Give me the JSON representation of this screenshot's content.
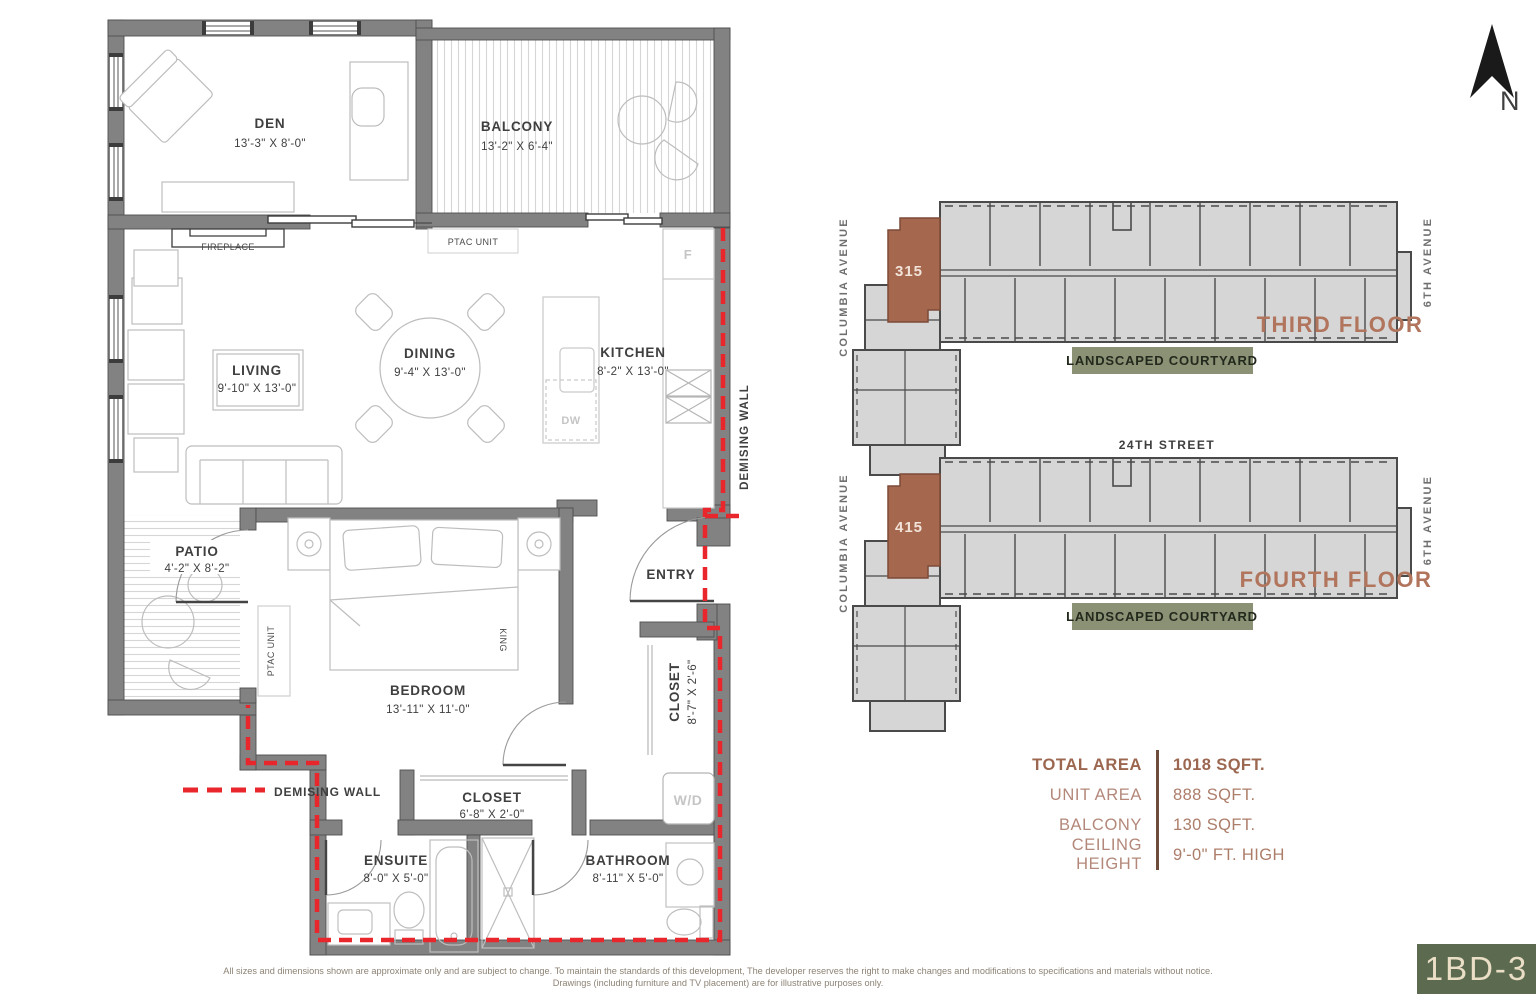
{
  "floorplan": {
    "rooms": {
      "den": {
        "name": "DEN",
        "dims": "13'-3\" X 8'-0\""
      },
      "balcony": {
        "name": "BALCONY",
        "dims": "13'-2\" X 6'-4\""
      },
      "living": {
        "name": "LIVING",
        "dims": "9'-10\" X 13'-0\""
      },
      "dining": {
        "name": "DINING",
        "dims": "9'-4\" X 13'-0\""
      },
      "kitchen": {
        "name": "KITCHEN",
        "dims": "8'-2\" X 13'-0\""
      },
      "patio": {
        "name": "PATIO",
        "dims": "4'-2\" X 8'-2\""
      },
      "bedroom": {
        "name": "BEDROOM",
        "dims": "13'-11\" X 11'-0\""
      },
      "entry": {
        "name": "ENTRY"
      },
      "entry_closet": {
        "name": "CLOSET",
        "dims": "8'-7\" X 2'-6\""
      },
      "bedroom_closet": {
        "name": "CLOSET",
        "dims": "6'-8\" X 2'-0\""
      },
      "ensuite": {
        "name": "ENSUITE",
        "dims": "8'-0\" X 5'-0\""
      },
      "bathroom": {
        "name": "BATHROOM",
        "dims": "8'-11\" X 5'-0\""
      }
    },
    "labels": {
      "fireplace": "FIREPLACE",
      "ptac_balcony": "PTAC UNIT",
      "ptac_patio": "PTAC UNIT",
      "fridge": "F",
      "dishwasher": "DW",
      "washer_dryer": "W/D",
      "king": "KING",
      "demising_vertical": "DEMISING WALL",
      "demising_legend": "DEMISING WALL"
    }
  },
  "keyplans": {
    "third": {
      "title": "THIRD FLOOR",
      "unit": "315",
      "left_street": "COLUMBIA AVENUE",
      "right_street": "6TH AVENUE",
      "courtyard": "LANDSCAPED COURTYARD"
    },
    "fourth": {
      "title": "FOURTH FLOOR",
      "unit": "415",
      "left_street": "COLUMBIA AVENUE",
      "right_street": "6TH AVENUE",
      "top_street": "24TH STREET",
      "courtyard": "LANDSCAPED COURTYARD"
    }
  },
  "area_table": {
    "rows": [
      {
        "label": "TOTAL AREA",
        "value": "1018 SQFT."
      },
      {
        "label": "UNIT AREA",
        "value": "888 SQFT."
      },
      {
        "label": "BALCONY",
        "value": "130 SQFT."
      },
      {
        "label": "CEILING HEIGHT",
        "value": "9'-0\" FT. HIGH"
      }
    ]
  },
  "badge": {
    "label": "1BD-3"
  },
  "north": {
    "label": "N"
  },
  "disclaimer": {
    "line1": "All sizes and dimensions  shown are approximate only and are subject to change. To maintain the standards of this development, The developer reserves the right to make changes and modifications to specifications and materials without notice.",
    "line2": "Drawings (including furniture and TV placement) are for illustrative purposes only."
  },
  "colors": {
    "wall_gray": "#828282",
    "demising_red": "#E8262C",
    "accent_terracotta": "#B1745C",
    "unit_highlight": "#A5674E",
    "courtyard_green": "#8A9174",
    "badge_green": "#5C6B50",
    "badge_text": "#EADFC6"
  }
}
